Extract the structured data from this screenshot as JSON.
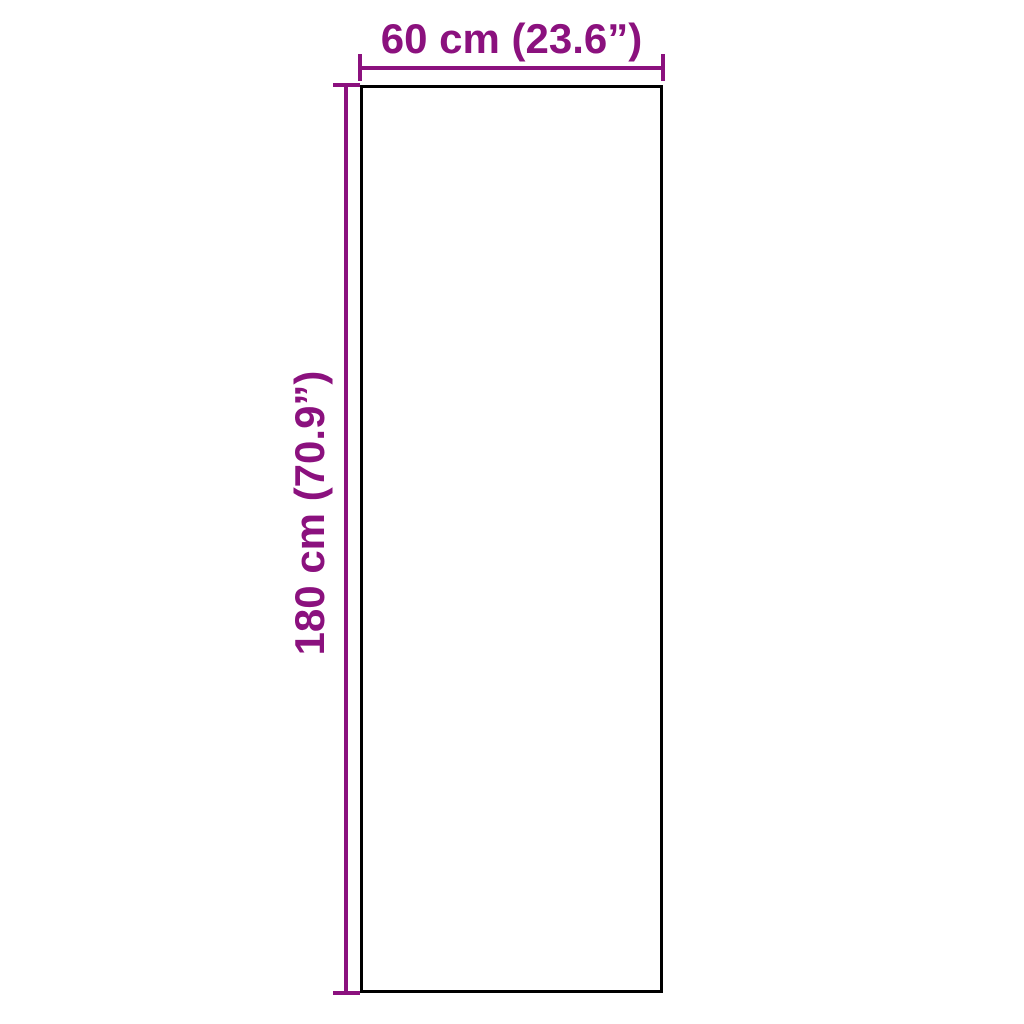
{
  "diagram": {
    "type": "product-dimension-diagram",
    "shape": "rectangle",
    "dimensions": {
      "width": {
        "label": "60 cm (23.6”)",
        "cm": 60,
        "inches": 23.6
      },
      "height": {
        "label": "180 cm (70.9”)",
        "cm": 180,
        "inches": 70.9
      }
    }
  },
  "colors": {
    "dimension_accent": "#8B117E",
    "outline": "#000000",
    "background": "#FFFFFF"
  }
}
